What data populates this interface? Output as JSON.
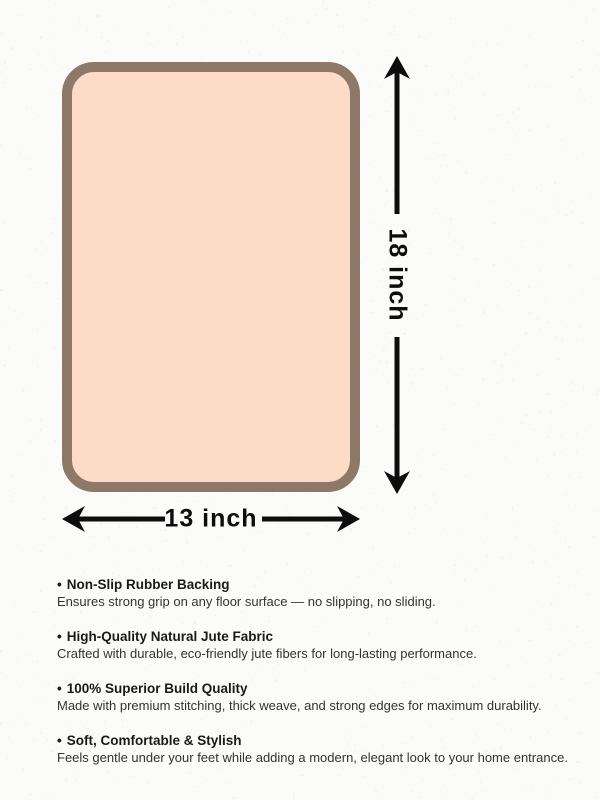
{
  "diagram": {
    "height_label": "18 inch",
    "width_label": "13 inch",
    "mat_fill_color": "#fddcc7",
    "mat_border_color": "#8e7969",
    "arrow_color": "#0d0d0d",
    "background_color": "#fbfbfa",
    "speckle_color": "#e2e2e2"
  },
  "features_meta": {
    "bullet": "•"
  },
  "features": [
    {
      "title": "Non-Slip Rubber Backing",
      "description": "Ensures strong grip on any floor surface — no slipping, no sliding."
    },
    {
      "title": "High-Quality Natural Jute Fabric",
      "description": "Crafted with durable, eco-friendly jute fibers for long-lasting performance."
    },
    {
      "title": "100% Superior Build Quality",
      "description": "Made with premium stitching, thick weave, and strong edges for maximum durability."
    },
    {
      "title": "Soft, Comfortable & Stylish",
      "description": "Feels gentle under your feet while adding a modern, elegant look to your home entrance."
    }
  ]
}
